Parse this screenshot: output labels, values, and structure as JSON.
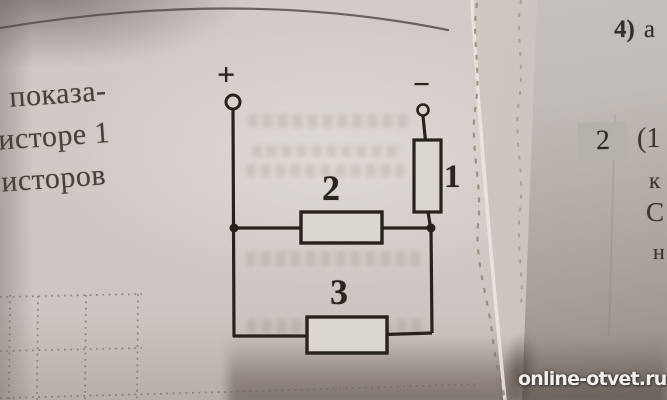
{
  "scene": {
    "description": "Photograph of a physics textbook page showing a resistor circuit; facing page torn out, edge remnants visible; answer-site watermark in corner"
  },
  "left_page": {
    "text_lines": [
      "показа-",
      "исторе 1",
      "исторов"
    ],
    "circuit": {
      "plus_terminal": "+",
      "minus_terminal": "−",
      "resistor_1_label": "1",
      "resistor_2_label": "2",
      "resistor_3_label": "3",
      "topology": "Resistor 1 hangs from the − terminal and is in series with resistors 2 and 3, which are connected in parallel between the two junction nodes of the + branch"
    }
  },
  "right_page": {
    "item_4": {
      "label": "4)",
      "text": "а"
    },
    "problem_2": {
      "number": "2",
      "text_start": "(1"
    },
    "clipped_fragments": [
      "к",
      "С",
      "н"
    ]
  },
  "watermark": {
    "text": "online-otvet.ru"
  },
  "colors": {
    "paper_left": "#d1cac6",
    "paper_right": "#c2bcb8",
    "circuit_ink": "#28221d",
    "print_text": "#474139",
    "highlight_box": "#b7b1ab",
    "torn_edge_dash": "#8f7460",
    "watermark_text": "#f1efec"
  }
}
